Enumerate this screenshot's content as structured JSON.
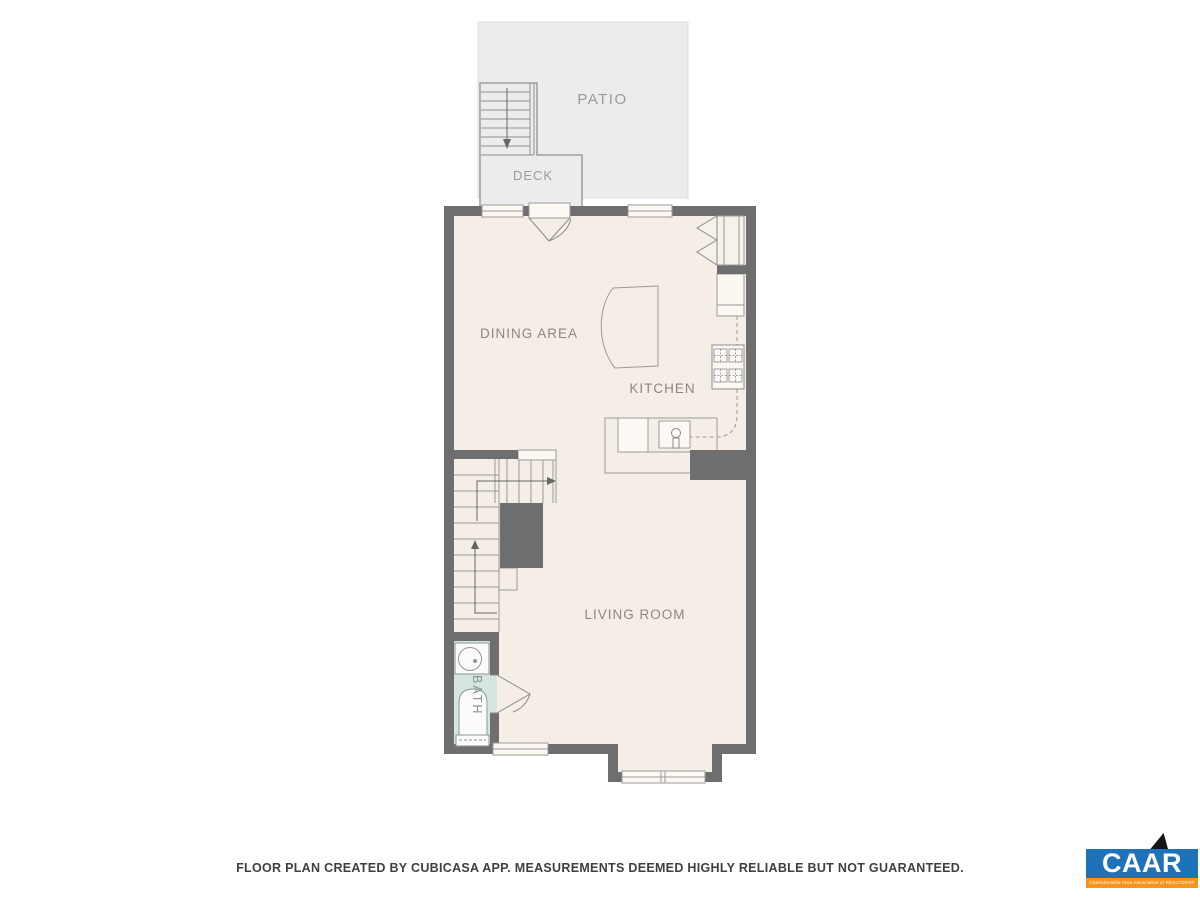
{
  "floor_plan": {
    "rooms": [
      {
        "id": "patio",
        "label": "PATIO"
      },
      {
        "id": "deck",
        "label": "DECK"
      },
      {
        "id": "dining",
        "label": "DINING AREA"
      },
      {
        "id": "kitchen",
        "label": "KITCHEN"
      },
      {
        "id": "living",
        "label": "LIVING ROOM"
      },
      {
        "id": "bath",
        "label": "BATH"
      }
    ],
    "colors": {
      "floor": "#f5eee6",
      "wall": "#6e6e6e",
      "outdoor": "#ececec",
      "bath_floor": "#d6e4e2",
      "thin_line": "#9a9a9a",
      "label_text": "#8d8781"
    }
  },
  "footer": {
    "disclaimer": "FLOOR PLAN CREATED BY CUBICASA APP. MEASUREMENTS DEEMED HIGHLY RELIABLE BUT NOT GUARANTEED."
  },
  "logo": {
    "acronym": "CAAR",
    "tagline": "Charlottesville Area Association of REALTORS®",
    "blue": "#1d72b9",
    "orange": "#f7941d"
  }
}
